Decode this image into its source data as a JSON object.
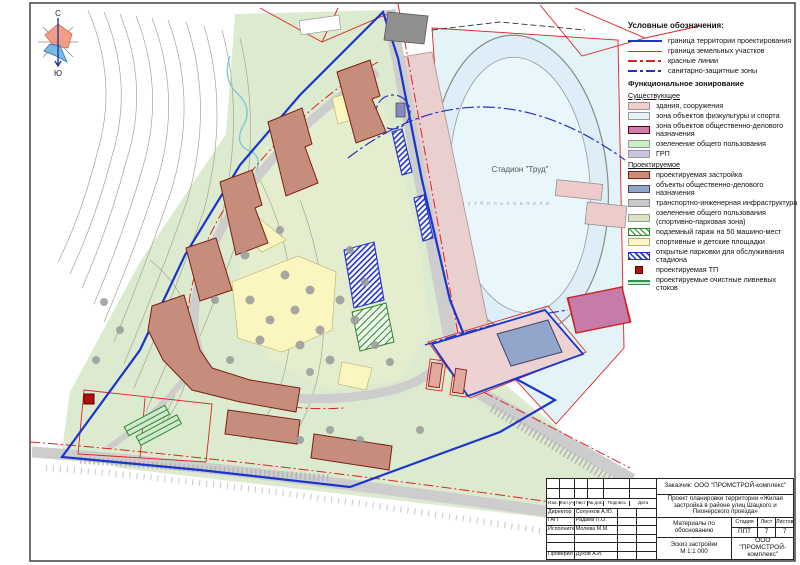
{
  "windrose": {
    "north": "С",
    "south": "Ю"
  },
  "map": {
    "stadium_label": "Стадион \"Труд\"",
    "field_label": "ф у т б о л ь н о е   п о л е"
  },
  "colors": {
    "boundary_blue": "#1a35cc",
    "parcel_red": "#dd2222",
    "red_lines": "#dd2222",
    "sanitary_blue": "#2233bb"
  },
  "legend": {
    "title": "Условные обозначения:",
    "lines": [
      {
        "label": "граница территории проектирования",
        "style": "ln-solid-blue"
      },
      {
        "label": "граница земельных участков",
        "style": "ln-solid-red"
      },
      {
        "label": "красные линии",
        "style": "ln-dd-red"
      },
      {
        "label": "санитарно-защитные зоны",
        "style": "ln-dd-blue"
      }
    ],
    "zoning_title": "Функциональное зонирование",
    "existing_title": "Существующее",
    "existing": [
      {
        "label": "здания, сооружения",
        "color": "#f2cdc9",
        "border": "#999999",
        "pattern": "solid"
      },
      {
        "label": "зона объектов физкультуры и спорта",
        "color": "#e3f3f7",
        "border": "#999999",
        "pattern": "solid"
      },
      {
        "label": "зона объектов общественно-делового назначения",
        "color": "#cb7fa6",
        "border": "#550022",
        "pattern": "solid"
      },
      {
        "label": "озеленение общего пользования",
        "color": "#c9f0c4",
        "border": "#999999",
        "pattern": "solid"
      },
      {
        "label": "ГРП",
        "color": "#c9c4e4",
        "border": "#999999",
        "pattern": "solid"
      }
    ],
    "planned_title": "Проектируемое",
    "planned": [
      {
        "label": "проектируемая застройка",
        "color": "#c78d7c",
        "border": "#7a1f12",
        "pattern": "solid"
      },
      {
        "label": "объекты общественно-делового назначения",
        "color": "#92a5cb",
        "border": "#444466",
        "pattern": "solid"
      },
      {
        "label": "транспортно-инженерная инфраструктура",
        "color": "#c9c9c9",
        "border": "#888888",
        "pattern": "solid"
      },
      {
        "label": "озеленение общего пользования (спортивно-парковая зона)",
        "color": "#d7e3c1",
        "border": "#999999",
        "pattern": "solid"
      },
      {
        "label": "подземный гараж на 50 машино-мест",
        "color": "",
        "border": "#2a8a2a",
        "pattern": "hatch-green"
      },
      {
        "label": "спортивные и детские площадки",
        "color": "#fcf7c6",
        "border": "#b8b06a",
        "pattern": "solid"
      },
      {
        "label": "открытые парковки для обслуживания стадиона",
        "color": "",
        "border": "#2233cc",
        "pattern": "hatch-blue"
      },
      {
        "label": "проектируемая ТП",
        "color": "#b01010",
        "border": "#550000",
        "pattern": "square"
      },
      {
        "label": "проектируемые очистные ливневых стоков",
        "color": "",
        "border": "",
        "pattern": "bars"
      }
    ]
  },
  "titleblock": {
    "client": "Заказчик: ООО \"ПРОМСТРОЙ-комплекс\"",
    "project": "Проект планировки территории «Жилая застройка в районе улиц Шацкого и Пионерского проезда»",
    "columns": [
      "Изм.",
      "Кол.уч",
      "Лист",
      "№ док.",
      "Подпись",
      "Дата"
    ],
    "signers": [
      {
        "role": "Директор",
        "name": "Солунков А.Ю."
      },
      {
        "role": "ГАП",
        "name": "Радаев П.О."
      },
      {
        "role": "Исполнител",
        "name": "Молева М.М."
      },
      {
        "role": "",
        "name": ""
      },
      {
        "role": "",
        "name": ""
      },
      {
        "role": "Проверил",
        "name": "Духов А.И."
      }
    ],
    "doc_type": "Материалы по обоснованию",
    "stage_label": "Стадия",
    "sheet_label": "Лист",
    "sheets_label": "Листов",
    "stage": "ППТ",
    "sheet": "7",
    "sheets": "7",
    "drawing": "Эскиз застройки",
    "scale": "М 1:1 000",
    "company": "ООО \"ПРОМСТРОЙ-комплекс\""
  }
}
